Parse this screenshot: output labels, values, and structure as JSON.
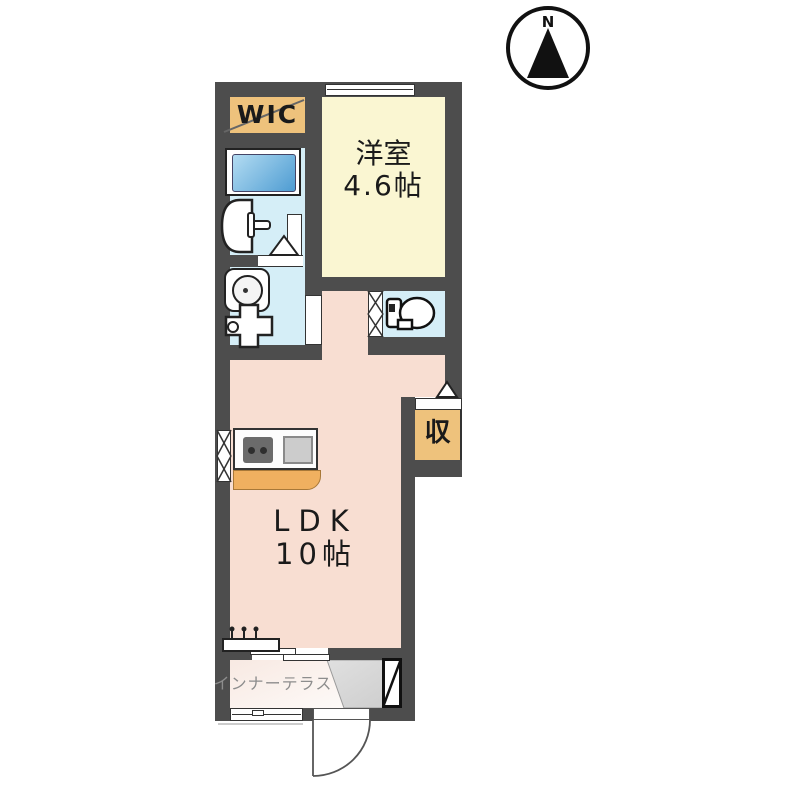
{
  "compass": {
    "label": "N"
  },
  "rooms": [
    {
      "id": "wic",
      "label": "WIC",
      "color": "#eec27c"
    },
    {
      "id": "western-room",
      "label": "洋室",
      "size": "4.6帖",
      "color": "#faf6d2"
    },
    {
      "id": "ldk",
      "label": "LDK",
      "size": "10帖",
      "color": "#f8ded2"
    },
    {
      "id": "storage",
      "label": "収",
      "color": "#eec27c"
    },
    {
      "id": "inner-terrace",
      "label": "インナーテラス",
      "color": "#f7e9e3"
    },
    {
      "id": "bathroom",
      "label": "",
      "color": "#d5eef7"
    },
    {
      "id": "toilet-room",
      "label": "",
      "color": "#d5eef7"
    }
  ],
  "fixtures": [
    "bathtub",
    "washbasin",
    "toilet",
    "washing-machine-pan",
    "kitchen-stove",
    "kitchen-sink",
    "shoe-cabinet",
    "entrance-door",
    "counter"
  ],
  "colors": {
    "wall": "#4d4d4d",
    "wet-area": "#d5eef7",
    "ldk": "#f8ded2",
    "western-room": "#faf6d2",
    "closet": "#eec27c",
    "entrance": "#d8d8d8"
  }
}
